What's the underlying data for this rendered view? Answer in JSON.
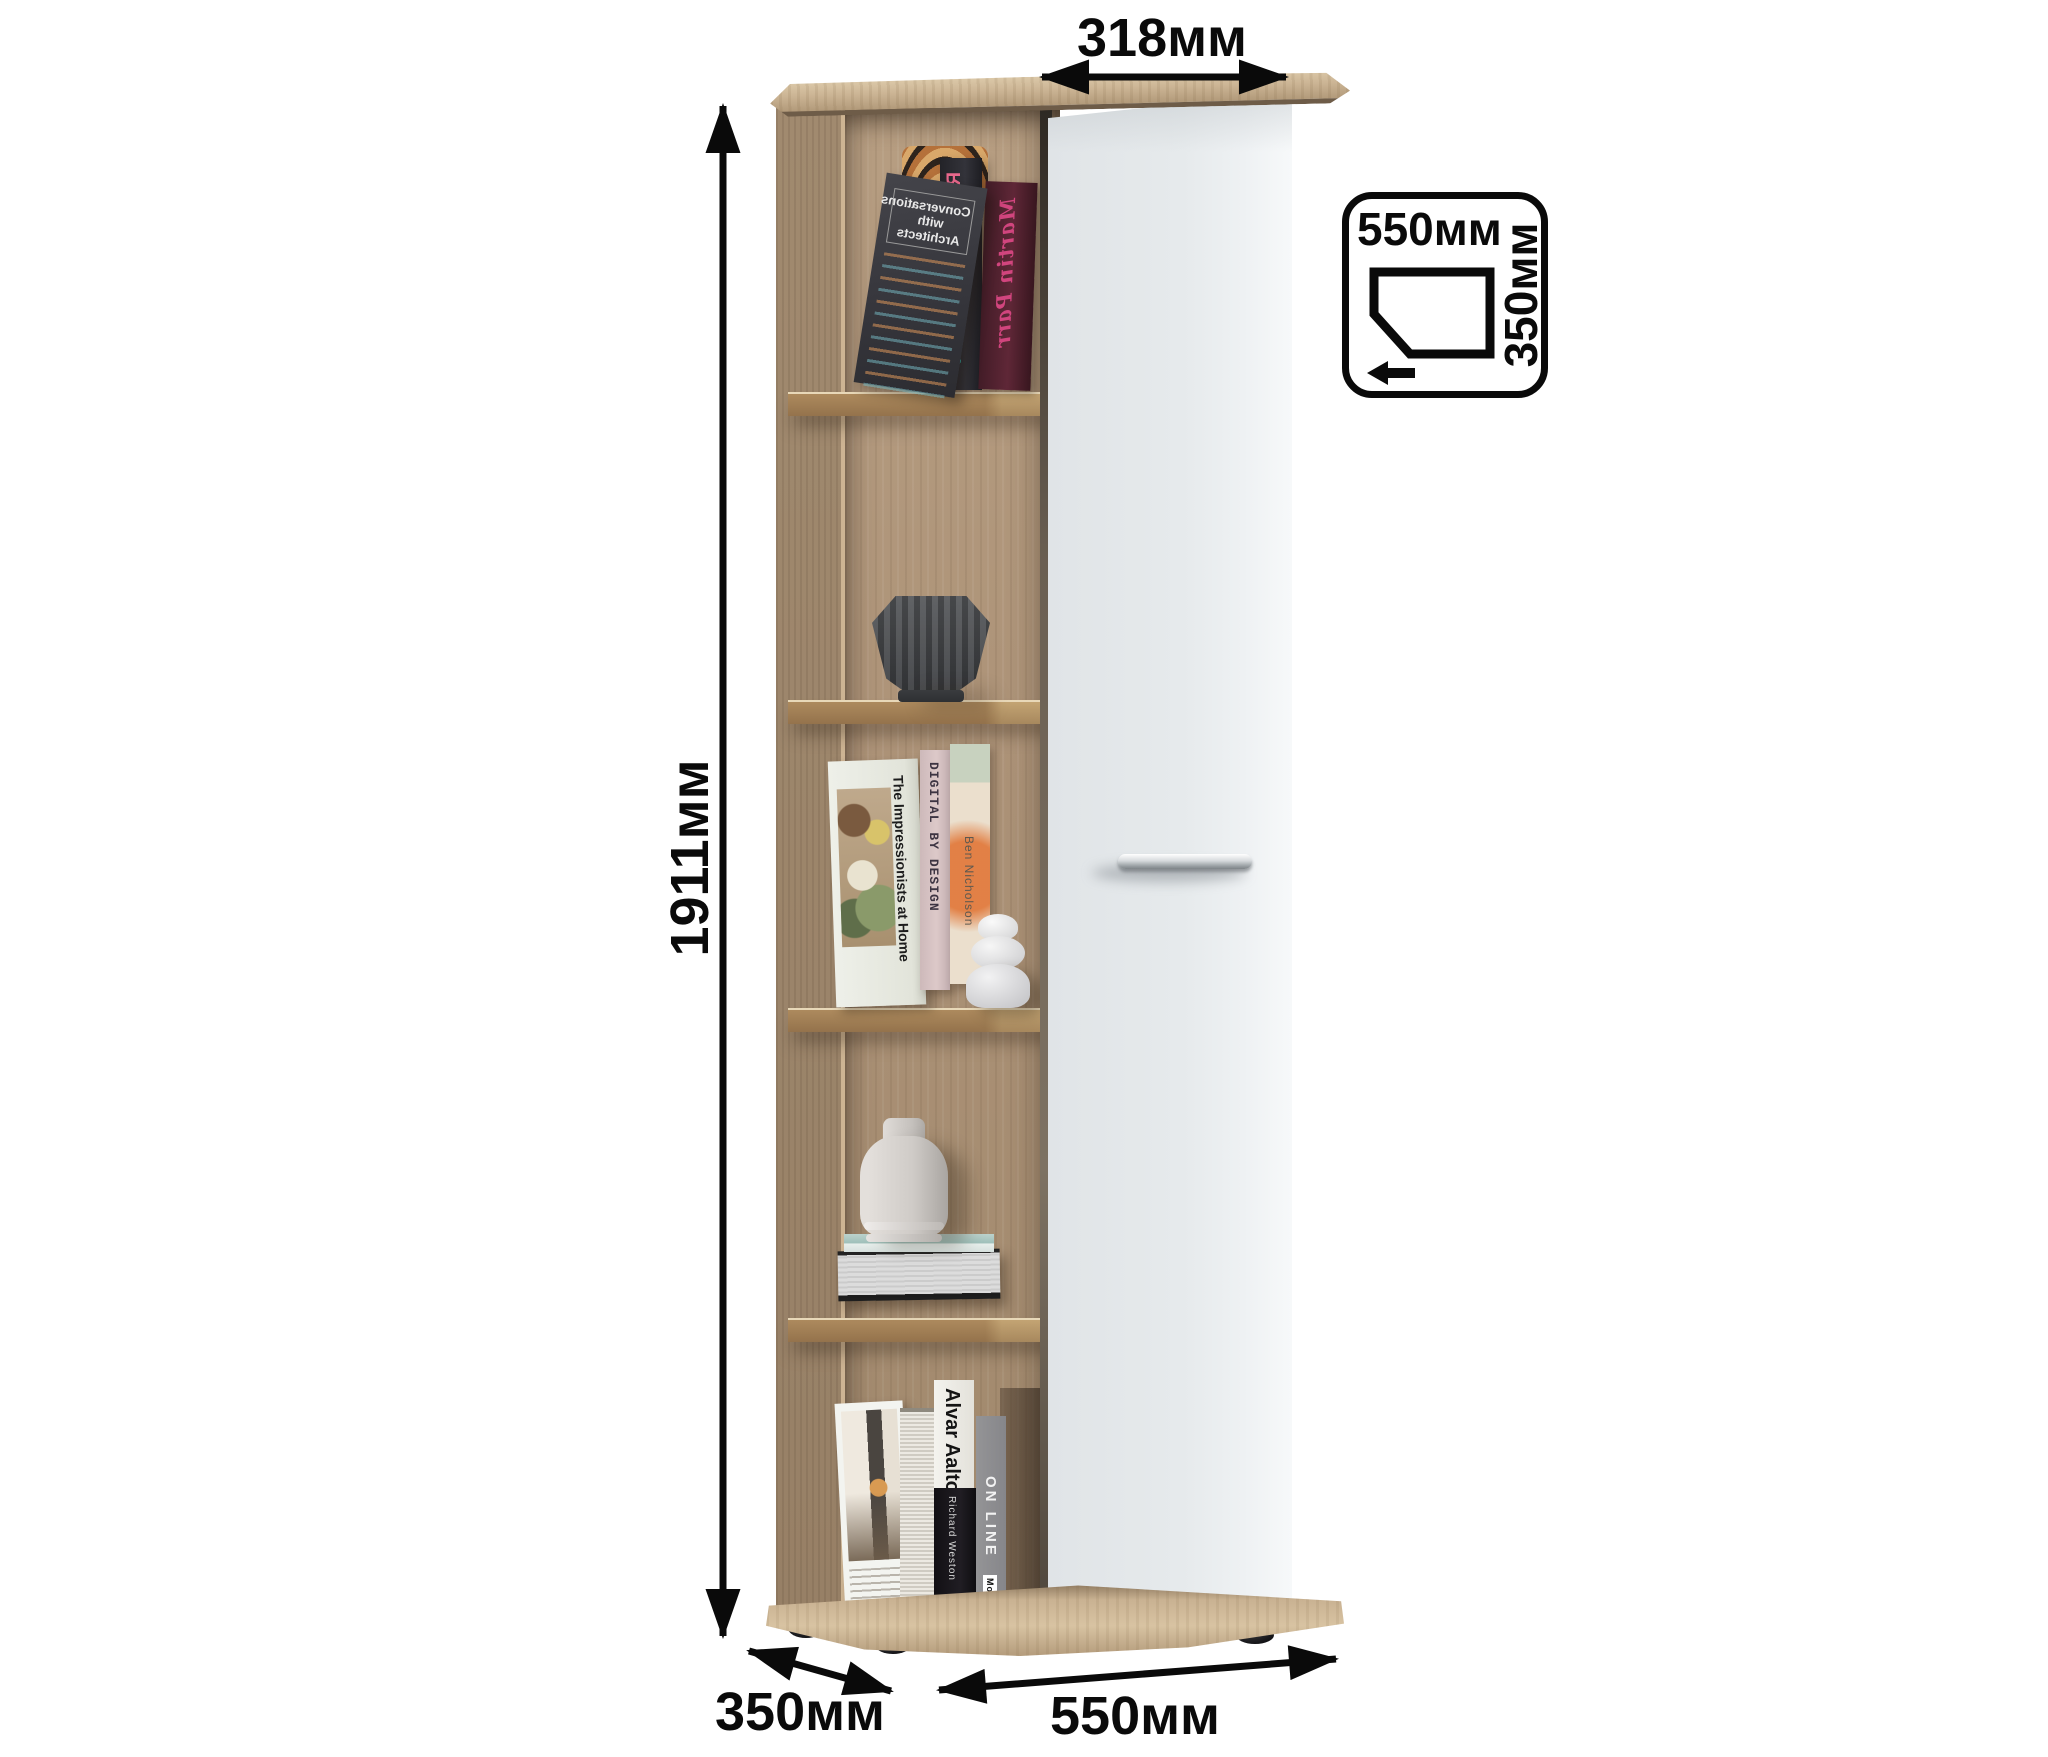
{
  "dimensions": {
    "door_width": "318мм",
    "height": "1911мм",
    "depth": "350мм",
    "width": "550мм"
  },
  "top_view": {
    "width": "550мм",
    "depth": "350мм"
  },
  "books": {
    "top_shelf": {
      "cover_title": "Conversations with Architects",
      "spine_author": "Ron Arad",
      "spine_title": "No Discipline",
      "script_title": "Martin Parr"
    },
    "middle_shelf": {
      "cover_title": "The Impressionists at Home",
      "spine_1": "DIGITAL BY DESIGN",
      "spine_2": "Ben Nicholson"
    },
    "bottom_shelf": {
      "spine_1": "Alvar Aalto",
      "spine_1_author": "Richard Weston",
      "spine_2": "ON LINE",
      "spine_2_publisher": "MoMA",
      "logo": "Φ"
    }
  },
  "colors": {
    "wood": "#ab9276",
    "wood_light": "#d2bc9c",
    "door": "#e8ecee",
    "annotation": "#0a0a0a"
  }
}
